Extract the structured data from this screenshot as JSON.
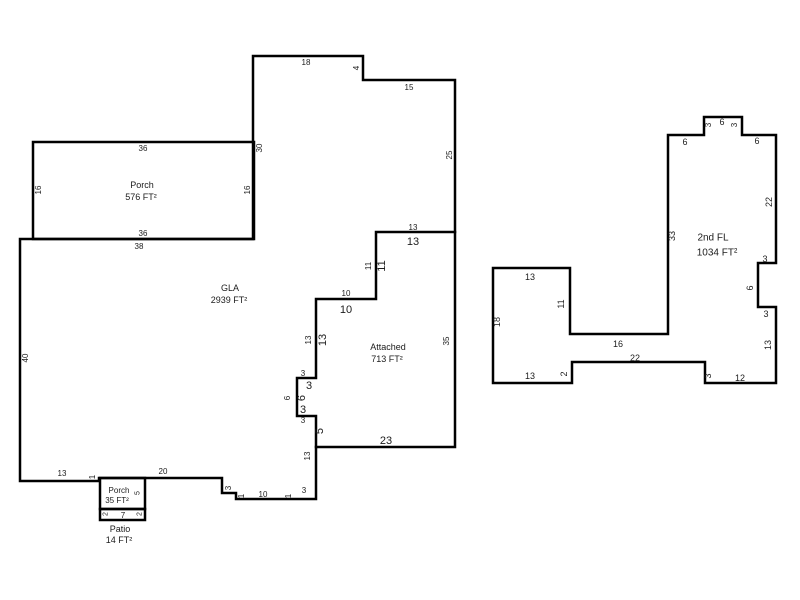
{
  "page": {
    "background": "#ffffff",
    "line_color": "#000000",
    "text_color": "#1c1c1c"
  },
  "regions": [
    {
      "name": "Porch",
      "area": "576 FT²"
    },
    {
      "name": "GLA",
      "area": "2939 FT²"
    },
    {
      "name": "Attached",
      "area": "713 FT²"
    },
    {
      "name": "Porch",
      "area": "35 FT²"
    },
    {
      "name": "Patio",
      "area": "14 FT²"
    },
    {
      "name": "2nd FL",
      "area": "1034 FT²"
    }
  ],
  "sketch": {
    "canvas": {
      "width": 800,
      "height": 600
    },
    "paths": [
      {
        "name": "main-floor-outline",
        "closed": true,
        "points": [
          [
            253,
            56
          ],
          [
            363,
            56
          ],
          [
            363,
            80
          ],
          [
            455,
            80
          ],
          [
            455,
            447
          ],
          [
            316,
            447
          ],
          [
            316,
            499
          ],
          [
            236,
            499
          ],
          [
            236,
            493
          ],
          [
            222,
            493
          ],
          [
            222,
            478
          ],
          [
            99,
            478
          ],
          [
            99,
            481
          ],
          [
            20,
            481
          ],
          [
            20,
            239
          ],
          [
            253,
            239
          ]
        ]
      },
      {
        "name": "gla-attached-divider",
        "closed": false,
        "points": [
          [
            455,
            232
          ],
          [
            376,
            232
          ],
          [
            376,
            299
          ],
          [
            316,
            299
          ],
          [
            316,
            378
          ],
          [
            297,
            378
          ],
          [
            297,
            416
          ],
          [
            316,
            416
          ],
          [
            316,
            447
          ]
        ]
      },
      {
        "name": "porch-outline",
        "closed": true,
        "points": [
          [
            33,
            142
          ],
          [
            254,
            142
          ],
          [
            254,
            239
          ],
          [
            33,
            239
          ]
        ]
      },
      {
        "name": "small-porch-outline",
        "closed": true,
        "points": [
          [
            100,
            478
          ],
          [
            145,
            478
          ],
          [
            145,
            509
          ],
          [
            100,
            509
          ]
        ]
      },
      {
        "name": "patio-outline",
        "closed": true,
        "points": [
          [
            100,
            509
          ],
          [
            145,
            509
          ],
          [
            145,
            520
          ],
          [
            100,
            520
          ]
        ]
      },
      {
        "name": "second-floor-outline",
        "closed": true,
        "points": [
          [
            668,
            135
          ],
          [
            704,
            135
          ],
          [
            704,
            117
          ],
          [
            742,
            117
          ],
          [
            742,
            135
          ],
          [
            776,
            135
          ],
          [
            776,
            263
          ],
          [
            758,
            263
          ],
          [
            758,
            307
          ],
          [
            776,
            307
          ],
          [
            776,
            383
          ],
          [
            705,
            383
          ],
          [
            705,
            362
          ],
          [
            572,
            362
          ],
          [
            572,
            383
          ],
          [
            493,
            383
          ],
          [
            493,
            268
          ],
          [
            570,
            268
          ],
          [
            570,
            334
          ],
          [
            668,
            334
          ]
        ]
      }
    ],
    "labels": [
      {
        "x": 306,
        "y": 62,
        "t": "18",
        "s": 8,
        "r": 0
      },
      {
        "x": 356,
        "y": 68,
        "t": "4",
        "s": 8,
        "r": -90
      },
      {
        "x": 409,
        "y": 87,
        "t": "15",
        "s": 8,
        "r": 0
      },
      {
        "x": 449,
        "y": 155,
        "t": "25",
        "s": 8,
        "r": -90
      },
      {
        "x": 259,
        "y": 148,
        "t": "30",
        "s": 8,
        "r": -90
      },
      {
        "x": 143,
        "y": 148,
        "t": "36",
        "s": 8,
        "r": 0
      },
      {
        "x": 38,
        "y": 190,
        "t": "16",
        "s": 8,
        "r": -90
      },
      {
        "x": 247,
        "y": 190,
        "t": "16",
        "s": 8,
        "r": -90
      },
      {
        "x": 142,
        "y": 185,
        "t": "Porch",
        "s": 9,
        "r": 0,
        "name": "region-label-porch"
      },
      {
        "x": 141,
        "y": 197,
        "t": "576 FT²",
        "s": 9,
        "r": 0,
        "name": "region-area-porch"
      },
      {
        "x": 143,
        "y": 233,
        "t": "36",
        "s": 8,
        "r": 0
      },
      {
        "x": 139,
        "y": 246,
        "t": "38",
        "s": 8,
        "r": 0
      },
      {
        "x": 413,
        "y": 227,
        "t": "13",
        "s": 8,
        "r": 0
      },
      {
        "x": 413,
        "y": 241,
        "t": "13",
        "s": 11,
        "r": 0
      },
      {
        "x": 368,
        "y": 266,
        "t": "11",
        "s": 8,
        "r": -90
      },
      {
        "x": 381,
        "y": 266,
        "t": "11",
        "s": 11,
        "r": -90
      },
      {
        "x": 346,
        "y": 293,
        "t": "10",
        "s": 8,
        "r": 0
      },
      {
        "x": 346,
        "y": 309,
        "t": "10",
        "s": 11,
        "r": 0
      },
      {
        "x": 230,
        "y": 288,
        "t": "GLA",
        "s": 9,
        "r": 0,
        "name": "region-label-gla"
      },
      {
        "x": 229,
        "y": 300,
        "t": "2939 FT²",
        "s": 9,
        "r": 0,
        "name": "region-area-gla"
      },
      {
        "x": 308,
        "y": 340,
        "t": "13",
        "s": 8,
        "r": -90
      },
      {
        "x": 322,
        "y": 340,
        "t": "13",
        "s": 11,
        "r": -90
      },
      {
        "x": 303,
        "y": 373,
        "t": "3",
        "s": 8,
        "r": 0
      },
      {
        "x": 309,
        "y": 385,
        "t": "3",
        "s": 11,
        "r": 0
      },
      {
        "x": 287,
        "y": 398,
        "t": "6",
        "s": 8,
        "r": -90
      },
      {
        "x": 301,
        "y": 398,
        "t": "6",
        "s": 11,
        "r": -90
      },
      {
        "x": 303,
        "y": 409,
        "t": "3",
        "s": 11,
        "r": 0
      },
      {
        "x": 303,
        "y": 420,
        "t": "3",
        "s": 8,
        "r": 0
      },
      {
        "x": 307,
        "y": 456,
        "t": "13",
        "s": 8,
        "r": -90
      },
      {
        "x": 319,
        "y": 431,
        "t": "5",
        "s": 11,
        "r": -90
      },
      {
        "x": 388,
        "y": 347,
        "t": "Attached",
        "s": 9,
        "r": 0,
        "name": "region-label-attached"
      },
      {
        "x": 387,
        "y": 359,
        "t": "713 FT²",
        "s": 9,
        "r": 0,
        "name": "region-area-attached"
      },
      {
        "x": 446,
        "y": 341,
        "t": "35",
        "s": 8,
        "r": -90
      },
      {
        "x": 386,
        "y": 440,
        "t": "23",
        "s": 11,
        "r": 0
      },
      {
        "x": 228,
        "y": 488,
        "t": "3",
        "s": 8,
        "r": -90
      },
      {
        "x": 241,
        "y": 496,
        "t": "1",
        "s": 8,
        "r": -90
      },
      {
        "x": 263,
        "y": 494,
        "t": "10",
        "s": 8,
        "r": 0
      },
      {
        "x": 288,
        "y": 496,
        "t": "1",
        "s": 8,
        "r": -90
      },
      {
        "x": 304,
        "y": 490,
        "t": "3",
        "s": 8,
        "r": 0
      },
      {
        "x": 163,
        "y": 471,
        "t": "20",
        "s": 8,
        "r": 0
      },
      {
        "x": 62,
        "y": 473,
        "t": "13",
        "s": 8,
        "r": 0
      },
      {
        "x": 92,
        "y": 477,
        "t": "1",
        "s": 8,
        "r": -90
      },
      {
        "x": 25,
        "y": 358,
        "t": "40",
        "s": 8,
        "r": -90
      },
      {
        "x": 119,
        "y": 490,
        "t": "Porch",
        "s": 8,
        "r": 0,
        "name": "region-label-small-porch"
      },
      {
        "x": 117,
        "y": 500,
        "t": "35 FT²",
        "s": 8,
        "r": 0,
        "name": "region-area-small-porch"
      },
      {
        "x": 137,
        "y": 493,
        "t": "5",
        "s": 7,
        "r": -90
      },
      {
        "x": 105,
        "y": 514,
        "t": "2",
        "s": 7,
        "r": -90
      },
      {
        "x": 123,
        "y": 515,
        "t": "7",
        "s": 8,
        "r": 0
      },
      {
        "x": 139,
        "y": 514,
        "t": "2",
        "s": 7,
        "r": -90
      },
      {
        "x": 120,
        "y": 529,
        "t": "Patio",
        "s": 9,
        "r": 0,
        "name": "region-label-patio"
      },
      {
        "x": 119,
        "y": 540,
        "t": "14 FT²",
        "s": 9,
        "r": 0,
        "name": "region-area-patio"
      },
      {
        "x": 685,
        "y": 142,
        "t": "6",
        "s": 9,
        "r": 0
      },
      {
        "x": 708,
        "y": 125,
        "t": "3",
        "s": 8,
        "r": -90
      },
      {
        "x": 722,
        "y": 122,
        "t": "6",
        "s": 9,
        "r": 0
      },
      {
        "x": 734,
        "y": 125,
        "t": "3",
        "s": 8,
        "r": -90
      },
      {
        "x": 757,
        "y": 141,
        "t": "6",
        "s": 9,
        "r": 0
      },
      {
        "x": 769,
        "y": 202,
        "t": "22",
        "s": 9,
        "r": -90
      },
      {
        "x": 672,
        "y": 236,
        "t": "33",
        "s": 9,
        "r": -90
      },
      {
        "x": 713,
        "y": 237,
        "t": "2nd FL",
        "s": 10,
        "r": 0,
        "name": "region-label-2nd-fl"
      },
      {
        "x": 717,
        "y": 252,
        "t": "1034 FT²",
        "s": 10,
        "r": 0,
        "name": "region-area-2nd-fl"
      },
      {
        "x": 765,
        "y": 259,
        "t": "3",
        "s": 9,
        "r": 0
      },
      {
        "x": 750,
        "y": 288,
        "t": "6",
        "s": 9,
        "r": -90
      },
      {
        "x": 766,
        "y": 314,
        "t": "3",
        "s": 9,
        "r": 0
      },
      {
        "x": 768,
        "y": 345,
        "t": "13",
        "s": 9,
        "r": -90
      },
      {
        "x": 740,
        "y": 378,
        "t": "12",
        "s": 9,
        "r": 0
      },
      {
        "x": 708,
        "y": 376,
        "t": "3",
        "s": 9,
        "r": -90
      },
      {
        "x": 635,
        "y": 358,
        "t": "22",
        "s": 9,
        "r": 0
      },
      {
        "x": 564,
        "y": 374,
        "t": "2",
        "s": 9,
        "r": -90
      },
      {
        "x": 530,
        "y": 376,
        "t": "13",
        "s": 9,
        "r": 0
      },
      {
        "x": 497,
        "y": 322,
        "t": "18",
        "s": 9,
        "r": -90
      },
      {
        "x": 530,
        "y": 277,
        "t": "13",
        "s": 9,
        "r": 0
      },
      {
        "x": 561,
        "y": 304,
        "t": "11",
        "s": 9,
        "r": -90
      },
      {
        "x": 618,
        "y": 344,
        "t": "16",
        "s": 9,
        "r": 0
      }
    ]
  }
}
